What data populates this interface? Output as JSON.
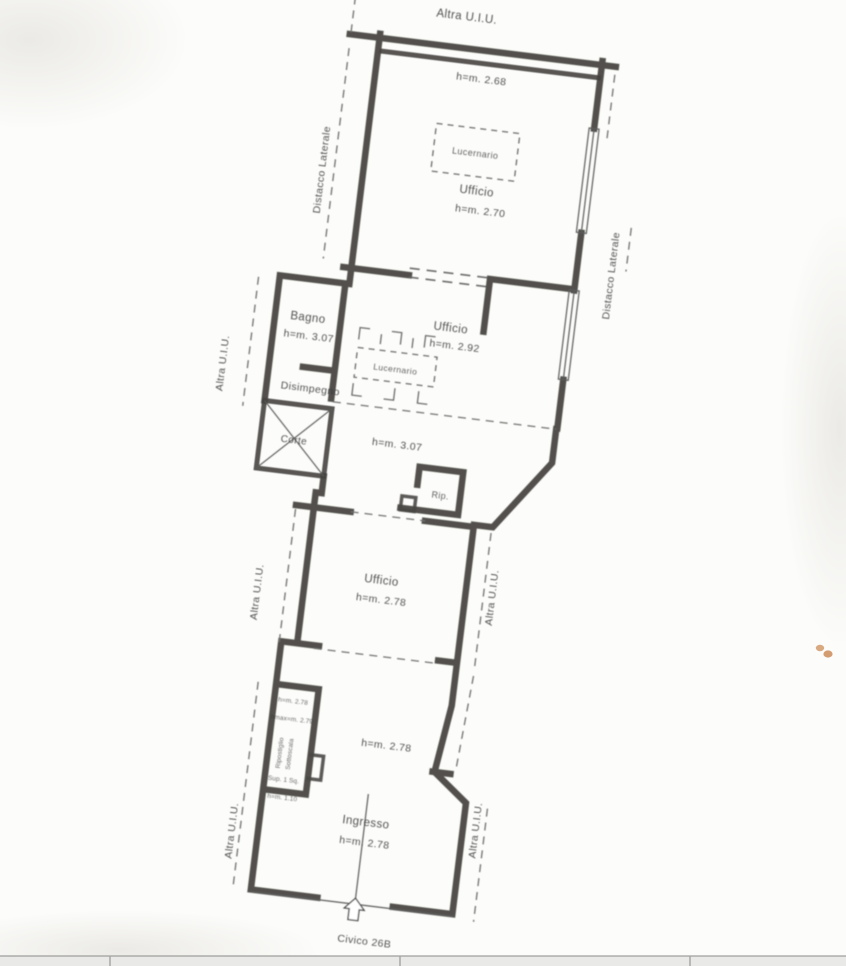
{
  "plan": {
    "boundary_labels": {
      "top": "Altra U.I.U.",
      "left_upper": "Distacco Laterale",
      "right_upper": "Distacco Laterale",
      "left_mid_upper": "Altra U.I.U.",
      "left_mid": "Altra U.I.U.",
      "right_mid": "Altra U.I.U.",
      "left_bottom": "Altra U.I.U.",
      "right_bottom": "Altra U.I.U."
    },
    "rooms": {
      "ufficio_top": {
        "name": "Ufficio",
        "height": "h=m. 2.70",
        "skylight": "Lucernario",
        "ceiling_note": "h=m. 2.68"
      },
      "bagno": {
        "name": "Bagno",
        "height": "h=m. 3.07"
      },
      "ufficio_mid": {
        "name": "Ufficio",
        "height": "h=m. 2.92",
        "skylight": "Lucernario"
      },
      "disimpegno": {
        "name": "Disimpegno"
      },
      "corte": {
        "name": "Corte"
      },
      "open_area": {
        "height": "h=m. 3.07"
      },
      "rip": {
        "name": "Rip."
      },
      "ufficio_lower": {
        "name": "Ufficio",
        "height": "h=m. 2.78"
      },
      "ripostiglio": {
        "h1": "h=m. 2.78",
        "h2": "hmax=m. 2.79",
        "name_line1": "Ripostiglio",
        "name_line2": "Sottoscala",
        "sup": "Sup. 1 Sq.",
        "h3": "h=m. 1.10"
      },
      "central": {
        "height": "h=m. 2.78"
      },
      "ingresso": {
        "name": "Ingresso",
        "height": "h=m. 2.78"
      }
    },
    "entrance": {
      "street_label": "Civico 26B"
    }
  },
  "colors": {
    "wall": "#454340",
    "paper": "#fcfcfa",
    "smudge": "#cf8a55",
    "footer_band": "#e9e9e7"
  }
}
